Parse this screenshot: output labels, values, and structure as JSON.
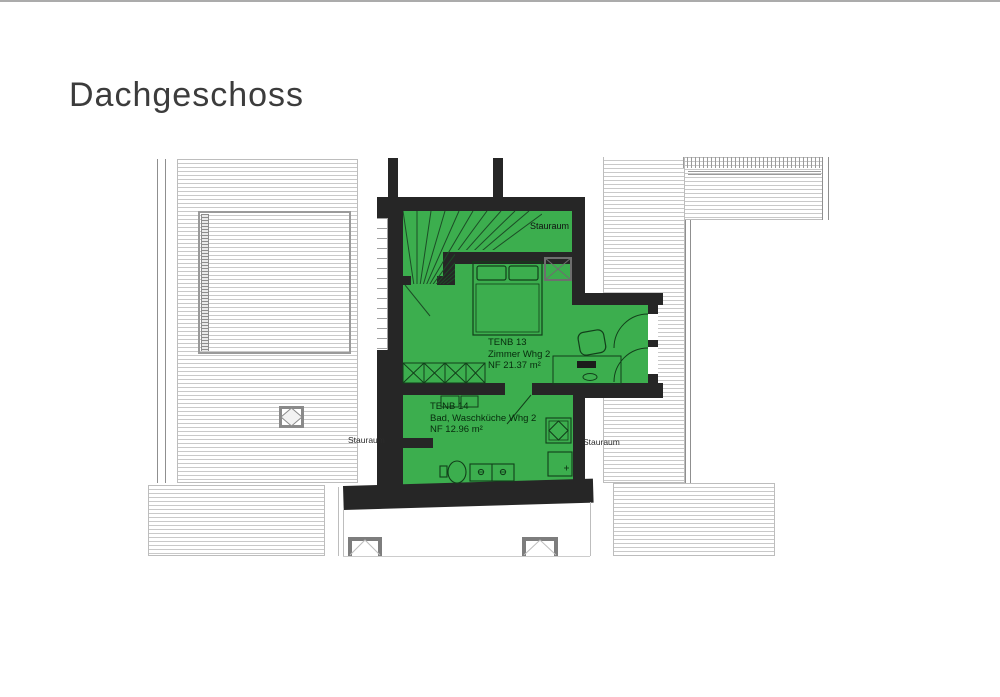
{
  "page": {
    "title": "Dachgeschoss"
  },
  "colors": {
    "room_highlight": "#3cae4e",
    "wall": "#262626",
    "roof_hatch_line": "#c9c9c9"
  },
  "rooms": [
    {
      "id": "TENB 13",
      "name": "Zimmer Whg 2",
      "area": "NF  21.37 m²"
    },
    {
      "id": "TENB 14",
      "name": "Bad, Waschküche Whg 2",
      "area": "NF  12.96 m²"
    }
  ],
  "labels": {
    "storage_inner": "Stauraum",
    "storage_left": "Stauraum",
    "storage_right": "Stauraum"
  }
}
